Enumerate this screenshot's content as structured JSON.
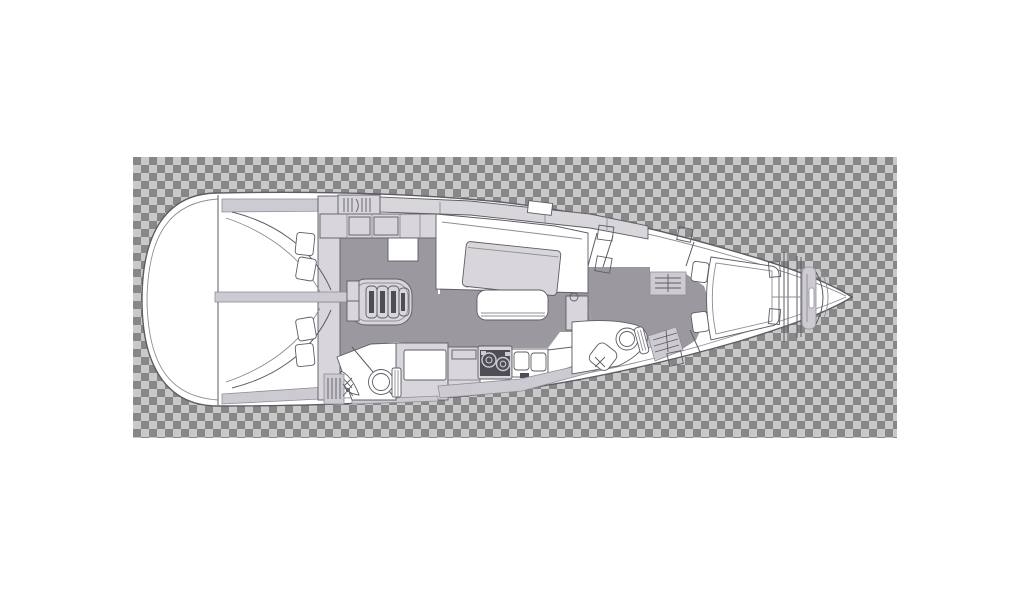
{
  "image": {
    "type": "sailboat-interior-floor-plan",
    "view": "top-down deck plan",
    "orientation": "bow-right-stern-left",
    "background": "transparency-checkerboard"
  },
  "canvas": {
    "width": 1024,
    "height": 600,
    "background": "#ffffff"
  },
  "checkerboard": {
    "x": 133,
    "y": 157,
    "width": 764,
    "height": 281,
    "cell": 8,
    "light": "#c9c9c9",
    "dark": "#878787"
  },
  "colors": {
    "hull_white": "#ffffff",
    "outline": "#5e5c64",
    "outline_light": "#8f8d95",
    "floor": "#9c98a0",
    "furniture": "#d8d6db",
    "trim": "#cdcbd1",
    "dark_detail": "#4e4c54"
  },
  "areas": [
    {
      "name": "transom-stern-platform"
    },
    {
      "name": "aft-cabin-port",
      "features": [
        "double-berth",
        "two-pillows"
      ]
    },
    {
      "name": "aft-cabin-starboard",
      "features": [
        "double-berth",
        "two-pillows"
      ]
    },
    {
      "name": "hanging-locker-aft-port"
    },
    {
      "name": "hanging-locker-aft-starboard"
    },
    {
      "name": "nav-cabinets"
    },
    {
      "name": "chart-table"
    },
    {
      "name": "companionway-steps"
    },
    {
      "name": "salon-settee-u-shape"
    },
    {
      "name": "salon-table"
    },
    {
      "name": "salon-bench"
    },
    {
      "name": "galley",
      "features": [
        "refrigerator",
        "counter",
        "two-burner-stove",
        "double-sink"
      ]
    },
    {
      "name": "head-aft",
      "features": [
        "toilet",
        "corner-washbasin",
        "shower-door"
      ]
    },
    {
      "name": "head-forward",
      "features": [
        "toilet",
        "washbasin",
        "cabinet-door"
      ]
    },
    {
      "name": "hanging-locker-midship"
    },
    {
      "name": "hanging-locker-forward"
    },
    {
      "name": "forward-cabin",
      "features": [
        "v-berth",
        "two-pillows",
        "side-shelves"
      ]
    },
    {
      "name": "collision-bulkhead"
    },
    {
      "name": "anchor-locker"
    },
    {
      "name": "bow"
    }
  ]
}
